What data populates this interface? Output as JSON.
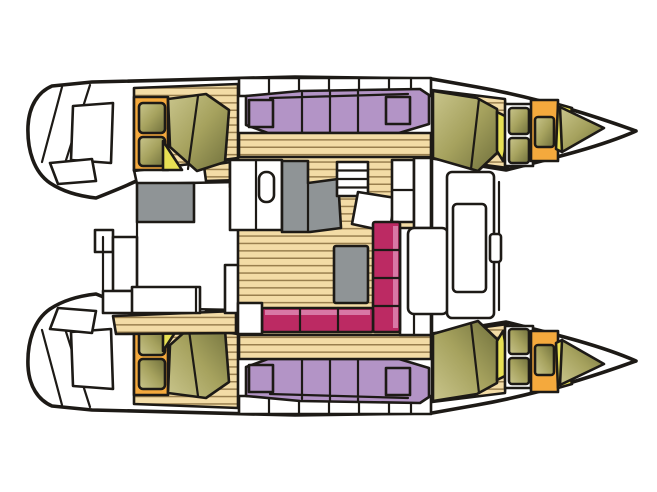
{
  "meta": {
    "description": "Top-down deck and interior layout plan of a sailing catamaran, bow pointing right; two symmetric hulls with cabins, central salon with galley, table and sofa, aft cockpit and forward cockpit"
  },
  "colors": {
    "bg": "#ffffff",
    "outline": "#1d1a16",
    "white": "#ffffff",
    "wood": "#f3dca6",
    "wood_line": "#8a6f3e",
    "olive": "#a6a25e",
    "olive_light": "#c9c58c",
    "olive_dark": "#70703c",
    "yellow": "#e7e054",
    "orange": "#f4a93d",
    "purple": "#b394c6",
    "magenta": "#bc2a63",
    "magenta_light": "#d878a5",
    "gray": "#8f9496"
  }
}
